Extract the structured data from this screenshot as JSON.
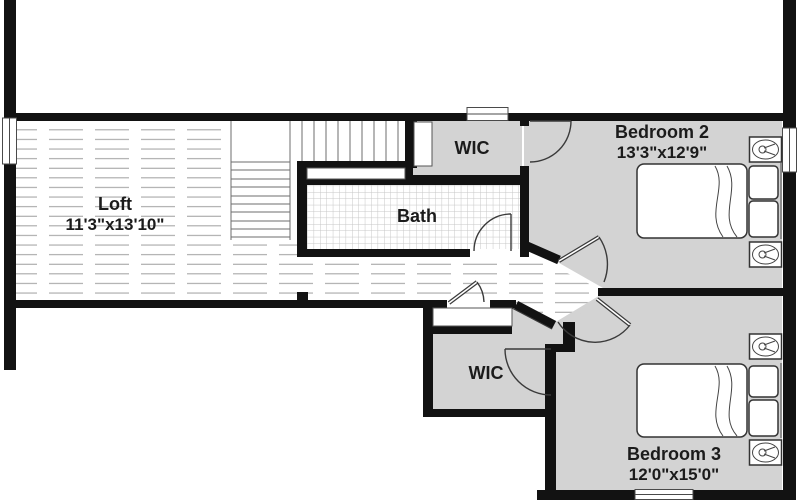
{
  "floorplan": {
    "title": "Second floor plan",
    "rooms": {
      "loft": {
        "name": "Loft",
        "dims": "11'3\"x13'10\""
      },
      "bath": {
        "name": "Bath"
      },
      "wic1": {
        "name": "WIC"
      },
      "wic2": {
        "name": "WIC"
      },
      "bedroom2": {
        "name": "Bedroom 2",
        "dims": "13'3\"x12'9\""
      },
      "bedroom3": {
        "name": "Bedroom 3",
        "dims": "12'0\"x15'0\""
      }
    },
    "colors": {
      "wall": "#121212",
      "room_fill": "#d3d3d3",
      "plank_line": "#9b9b9b",
      "tile_line": "#c7c7c7",
      "line": "#3a3a3a"
    }
  }
}
